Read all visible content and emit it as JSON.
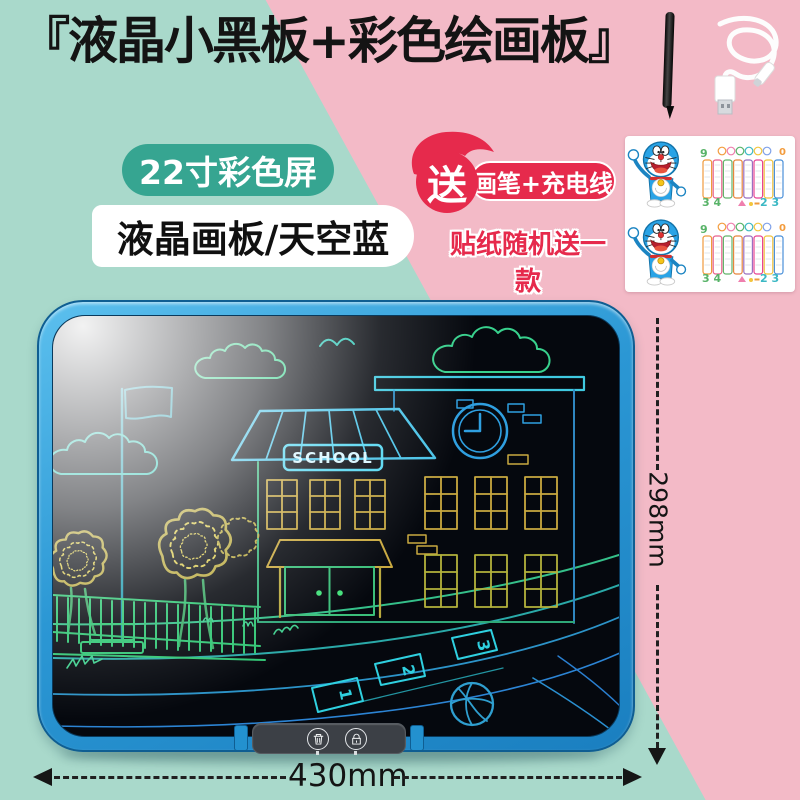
{
  "page": {
    "width": 800,
    "height": 800
  },
  "header": {
    "title": "『液晶小黑板+彩色绘画板』"
  },
  "badges": {
    "screen_size_label": "22寸彩色屏",
    "spec_label": "液晶画板/天空蓝",
    "gift_badge": "送",
    "gift_items_label": "画笔+充电线",
    "gift_note_label": "贴纸随机送一款"
  },
  "accessories": {
    "stylus_name": "stylus-pen",
    "cable_name": "usb-charging-cable",
    "sticker_names": [
      "doraemon-sticker",
      "multiplication-table-sticker"
    ],
    "table_digits": {
      "top_left": "9",
      "top_right": "0",
      "bottom_left": "3 4",
      "bottom_right": "2 3"
    }
  },
  "tablet": {
    "sign_text": "SCHOOL",
    "hopscotch_numbers": [
      "1",
      "2",
      "3"
    ],
    "button_icon_names": [
      "trash-icon",
      "lock-icon"
    ]
  },
  "dimensions": {
    "width_label": "430mm",
    "height_label": "298mm"
  },
  "colors": {
    "teal_background": "#a9d9cb",
    "pink_background": "#f3bac7",
    "badge_green": "#36a591",
    "badge_red": "#e62a4c",
    "frame_blue": "#2e9fdc",
    "screen_black": "#05080e"
  }
}
